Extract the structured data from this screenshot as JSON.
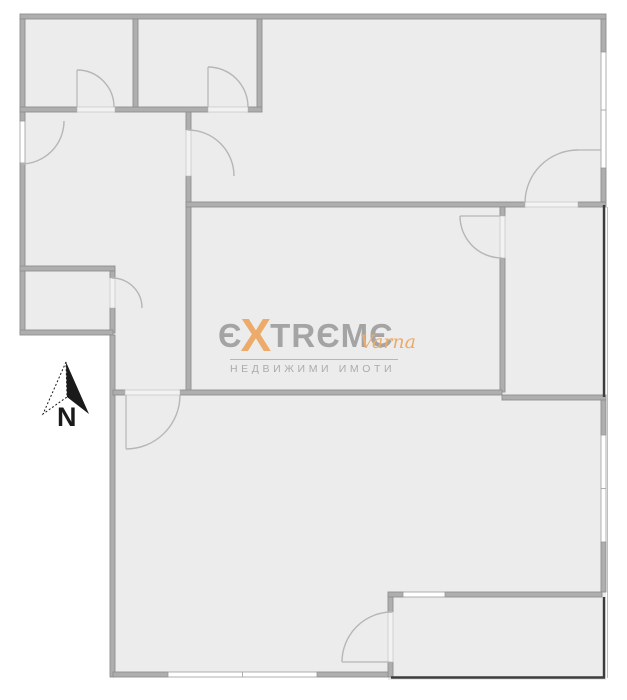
{
  "meta": {
    "width": 627,
    "height": 700,
    "background": "#ffffff"
  },
  "colors": {
    "floor": "#ececec",
    "wall_fill": "#aeaeae",
    "wall_stroke": "#8f8f8f",
    "window_fill": "#ffffff",
    "window_stroke": "#9c9c9c",
    "threshold_fill": "#f2f2f2",
    "threshold_stroke": "#bdbdbd",
    "door_arc": "#b6b6b6",
    "railing": "#3c3c3c",
    "shadow": "#8a8a8a",
    "logo_gray": "#9e9e9e",
    "logo_orange": "#eda65f",
    "logo_sub_gray": "#a6a6a6",
    "compass_black": "#1a1a1a"
  },
  "plan": {
    "floors": [
      {
        "x": 20,
        "y": 14,
        "w": 586,
        "h": 193
      },
      {
        "x": 20,
        "y": 110,
        "w": 170,
        "h": 223
      },
      {
        "x": 185,
        "y": 202,
        "w": 320,
        "h": 195
      },
      {
        "x": 500,
        "y": 202,
        "w": 106,
        "h": 198
      },
      {
        "x": 110,
        "y": 333,
        "w": 496,
        "h": 344
      },
      {
        "x": 388,
        "y": 592,
        "w": 218,
        "h": 88
      }
    ],
    "walls": [
      {
        "x": 20,
        "y": 14,
        "w": 586,
        "h": 5
      },
      {
        "x": 20,
        "y": 19,
        "w": 5,
        "h": 102
      },
      {
        "x": 20,
        "y": 163,
        "w": 5,
        "h": 170
      },
      {
        "x": 20,
        "y": 107,
        "w": 57,
        "h": 5
      },
      {
        "x": 115,
        "y": 107,
        "w": 93,
        "h": 5
      },
      {
        "x": 248,
        "y": 107,
        "w": 14,
        "h": 5
      },
      {
        "x": 133,
        "y": 19,
        "w": 5,
        "h": 88
      },
      {
        "x": 257,
        "y": 19,
        "w": 5,
        "h": 88
      },
      {
        "x": 186,
        "y": 112,
        "w": 5,
        "h": 18
      },
      {
        "x": 186,
        "y": 176,
        "w": 5,
        "h": 217
      },
      {
        "x": 186,
        "y": 202,
        "w": 339,
        "h": 5
      },
      {
        "x": 578,
        "y": 202,
        "w": 28,
        "h": 5
      },
      {
        "x": 500,
        "y": 207,
        "w": 5,
        "h": 9
      },
      {
        "x": 500,
        "y": 258,
        "w": 5,
        "h": 134
      },
      {
        "x": 20,
        "y": 266,
        "w": 95,
        "h": 5
      },
      {
        "x": 110,
        "y": 271,
        "w": 5,
        "h": 7
      },
      {
        "x": 110,
        "y": 308,
        "w": 5,
        "h": 25
      },
      {
        "x": 20,
        "y": 330,
        "w": 93,
        "h": 5
      },
      {
        "x": 110,
        "y": 335,
        "w": 5,
        "h": 342
      },
      {
        "x": 113,
        "y": 390,
        "w": 12,
        "h": 5
      },
      {
        "x": 180,
        "y": 390,
        "w": 322,
        "h": 5
      },
      {
        "x": 502,
        "y": 395,
        "w": 104,
        "h": 5
      },
      {
        "x": 113,
        "y": 672,
        "w": 55,
        "h": 5
      },
      {
        "x": 317,
        "y": 672,
        "w": 75,
        "h": 5
      },
      {
        "x": 601,
        "y": 19,
        "w": 5,
        "h": 33
      },
      {
        "x": 601,
        "y": 168,
        "w": 5,
        "h": 34
      },
      {
        "x": 601,
        "y": 400,
        "w": 5,
        "h": 35
      },
      {
        "x": 601,
        "y": 542,
        "w": 5,
        "h": 50
      },
      {
        "x": 388,
        "y": 592,
        "w": 15,
        "h": 5
      },
      {
        "x": 445,
        "y": 592,
        "w": 157,
        "h": 5
      },
      {
        "x": 388,
        "y": 597,
        "w": 5,
        "h": 15
      },
      {
        "x": 388,
        "y": 662,
        "w": 5,
        "h": 15
      }
    ],
    "windows": [
      {
        "x": 601,
        "y": 52,
        "w": 5,
        "h": 116,
        "tick": true
      },
      {
        "x": 601,
        "y": 435,
        "w": 5,
        "h": 107,
        "tick": true
      },
      {
        "x": 168,
        "y": 672,
        "w": 149,
        "h": 5,
        "tick": true
      },
      {
        "x": 20,
        "y": 121,
        "w": 5,
        "h": 42,
        "tick": false
      },
      {
        "x": 403,
        "y": 592,
        "w": 42,
        "h": 5,
        "tick": false
      }
    ],
    "thresholds": [
      {
        "x": 77,
        "y": 107,
        "w": 38,
        "h": 5
      },
      {
        "x": 208,
        "y": 107,
        "w": 40,
        "h": 5
      },
      {
        "x": 186,
        "y": 130,
        "w": 5,
        "h": 46
      },
      {
        "x": 500,
        "y": 216,
        "w": 5,
        "h": 42
      },
      {
        "x": 525,
        "y": 202,
        "w": 53,
        "h": 5
      },
      {
        "x": 110,
        "y": 278,
        "w": 5,
        "h": 30
      },
      {
        "x": 125,
        "y": 390,
        "w": 55,
        "h": 5
      },
      {
        "x": 388,
        "y": 612,
        "w": 5,
        "h": 50
      }
    ],
    "doors": [
      {
        "arc": "M77,70 A37,37 0 0 1 114,107",
        "leaf": "M77,70 L77,107"
      },
      {
        "arc": "M208,67 A40,40 0 0 1 248,107",
        "leaf": "M208,67 L208,107"
      },
      {
        "arc": "M64,121 A43,43 0 0 1 21,164",
        "leaf": ""
      },
      {
        "arc": "M188,130 A46,46 0 0 1 234,176",
        "leaf": ""
      },
      {
        "arc": "M525,203 A53,53 0 0 1 578,150",
        "leaf": "M578,150 L601,150"
      },
      {
        "arc": "M460,216 A42,42 0 0 0 502,258",
        "leaf": "M460,216 L500,216"
      },
      {
        "arc": "M112,278 A30,30 0 0 1 142,308",
        "leaf": ""
      },
      {
        "arc": "M180,395 A54,54 0 0 1 126,449",
        "leaf": "M126,395 L126,449"
      },
      {
        "arc": "M342,662 A50,50 0 0 1 392,612",
        "leaf": "M342,662 L390,662"
      }
    ],
    "railings": [
      {
        "points": "604,205 604,397"
      },
      {
        "points": "604,597 604,677.5 391,677.5"
      }
    ],
    "shadow_line": {
      "points": "607.5,207 607.5,678"
    }
  },
  "logo": {
    "letters": [
      "Є",
      "X",
      "T",
      "R",
      "Є",
      "M",
      "Є"
    ],
    "accent_index": 1,
    "word": "EXTREME",
    "varna": "Varna",
    "subtext": "НЕДВИЖИМИ ИМОТИ"
  },
  "compass": {
    "label": "N",
    "solid_wing": "66,362 89,414 67,397",
    "open_wing": "66,362 43,414 67,397"
  }
}
